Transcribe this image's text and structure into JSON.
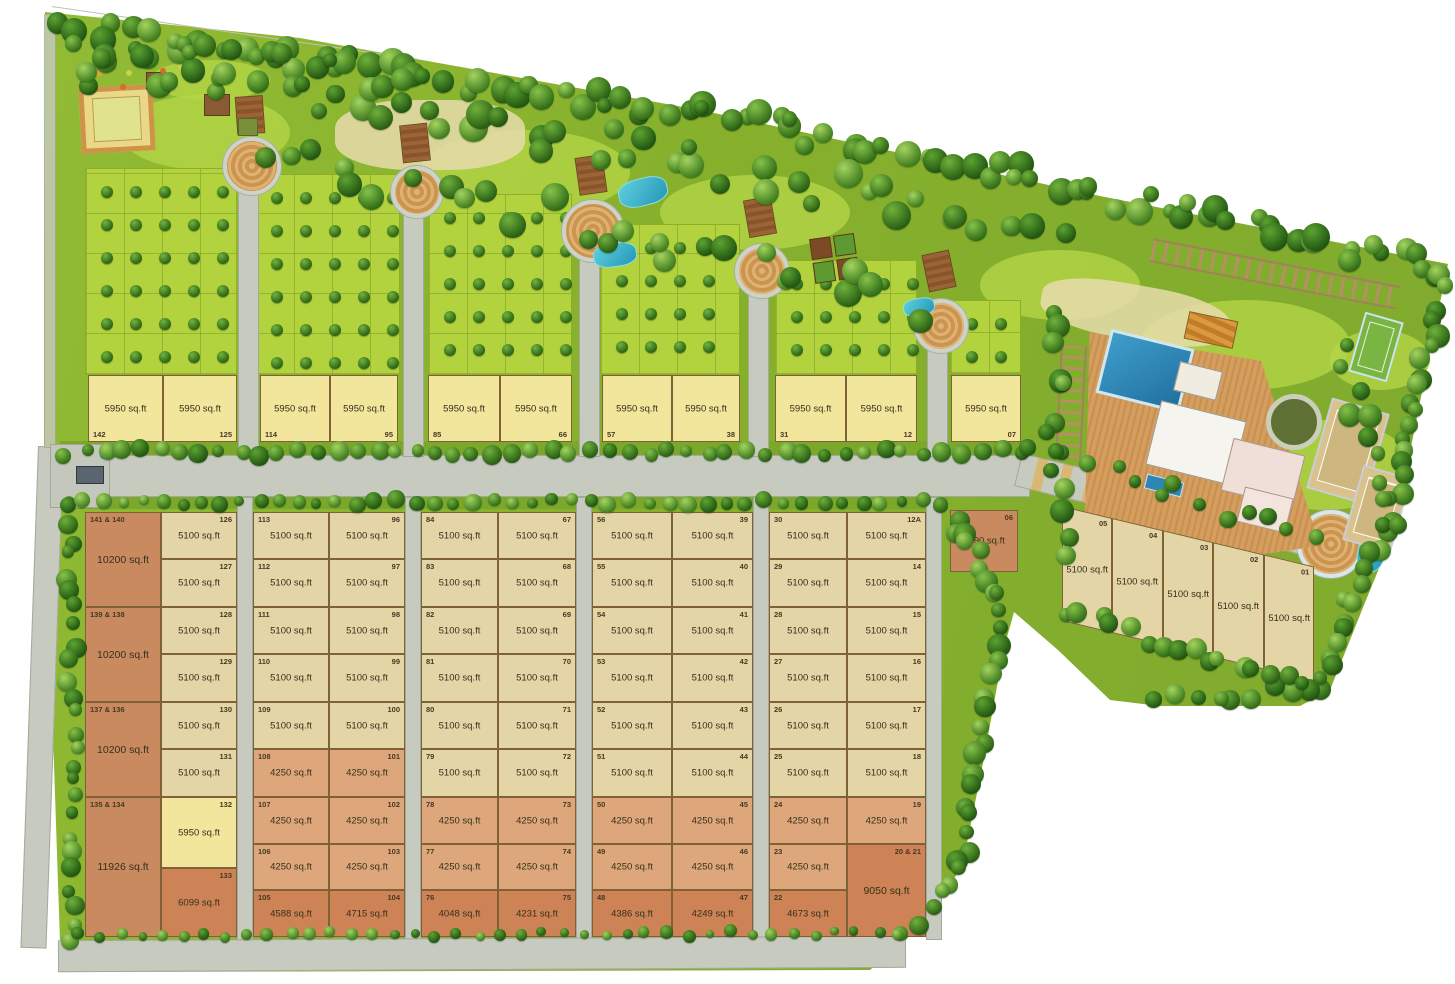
{
  "map": {
    "kind": "residential plotted development master plan",
    "area_unit": "sq.ft"
  },
  "colors": {
    "plot_5950": "#f2e59c",
    "plot_5100": "#e4d5a6",
    "plot_4250": "#dda77b",
    "plot_corner": "#cd8355",
    "plot_large": "#c98a60",
    "road": "#c7cabf",
    "lawn": "#a8cc35",
    "tree": "#2f6a16",
    "water": "#35b6c9",
    "deck": "#d0975a"
  },
  "top_row": [
    {
      "no": "142",
      "size": "5950 sq.ft"
    },
    {
      "no": "125",
      "size": "5950 sq.ft"
    },
    {
      "no": "114",
      "size": "5950 sq.ft"
    },
    {
      "no": "95",
      "size": "5950 sq.ft"
    },
    {
      "no": "85",
      "size": "5950 sq.ft"
    },
    {
      "no": "66",
      "size": "5950 sq.ft"
    },
    {
      "no": "57",
      "size": "5950 sq.ft"
    },
    {
      "no": "38",
      "size": "5950 sq.ft"
    },
    {
      "no": "31",
      "size": "5950 sq.ft"
    },
    {
      "no": "12",
      "size": "5950 sq.ft"
    },
    {
      "no": "07",
      "size": "5950 sq.ft"
    }
  ],
  "col1_left": [
    {
      "no": "141 & 140",
      "size": "10200 sq.ft"
    },
    {
      "no": "139 & 138",
      "size": "10200 sq.ft"
    },
    {
      "no": "137 & 136",
      "size": "10200 sq.ft"
    },
    {
      "no": "135 & 134",
      "size": "11926 sq.ft"
    }
  ],
  "col1_right": [
    {
      "no": "126",
      "size": "5100 sq.ft"
    },
    {
      "no": "127",
      "size": "5100 sq.ft"
    },
    {
      "no": "128",
      "size": "5100 sq.ft"
    },
    {
      "no": "129",
      "size": "5100 sq.ft"
    },
    {
      "no": "130",
      "size": "5100 sq.ft"
    },
    {
      "no": "131",
      "size": "5100 sq.ft"
    },
    {
      "no": "132",
      "size": "5950 sq.ft"
    },
    {
      "no": "133",
      "size": "6099 sq.ft"
    }
  ],
  "col2_left": [
    {
      "no": "113",
      "size": "5100 sq.ft"
    },
    {
      "no": "112",
      "size": "5100 sq.ft"
    },
    {
      "no": "111",
      "size": "5100 sq.ft"
    },
    {
      "no": "110",
      "size": "5100 sq.ft"
    },
    {
      "no": "109",
      "size": "5100 sq.ft"
    },
    {
      "no": "108",
      "size": "4250 sq.ft"
    },
    {
      "no": "107",
      "size": "4250 sq.ft"
    },
    {
      "no": "106",
      "size": "4250 sq.ft"
    },
    {
      "no": "105",
      "size": "4588 sq.ft"
    }
  ],
  "col2_right": [
    {
      "no": "96",
      "size": "5100 sq.ft"
    },
    {
      "no": "97",
      "size": "5100 sq.ft"
    },
    {
      "no": "98",
      "size": "5100 sq.ft"
    },
    {
      "no": "99",
      "size": "5100 sq.ft"
    },
    {
      "no": "100",
      "size": "5100 sq.ft"
    },
    {
      "no": "101",
      "size": "4250 sq.ft"
    },
    {
      "no": "102",
      "size": "4250 sq.ft"
    },
    {
      "no": "103",
      "size": "4250 sq.ft"
    },
    {
      "no": "104",
      "size": "4715 sq.ft"
    }
  ],
  "col3_left": [
    {
      "no": "84",
      "size": "5100 sq.ft"
    },
    {
      "no": "83",
      "size": "5100 sq.ft"
    },
    {
      "no": "82",
      "size": "5100 sq.ft"
    },
    {
      "no": "81",
      "size": "5100 sq.ft"
    },
    {
      "no": "80",
      "size": "5100 sq.ft"
    },
    {
      "no": "79",
      "size": "5100 sq.ft"
    },
    {
      "no": "78",
      "size": "4250 sq.ft"
    },
    {
      "no": "77",
      "size": "4250 sq.ft"
    },
    {
      "no": "76",
      "size": "4048 sq.ft"
    }
  ],
  "col3_right": [
    {
      "no": "67",
      "size": "5100 sq.ft"
    },
    {
      "no": "68",
      "size": "5100 sq.ft"
    },
    {
      "no": "69",
      "size": "5100 sq.ft"
    },
    {
      "no": "70",
      "size": "5100 sq.ft"
    },
    {
      "no": "71",
      "size": "5100 sq.ft"
    },
    {
      "no": "72",
      "size": "5100 sq.ft"
    },
    {
      "no": "73",
      "size": "4250 sq.ft"
    },
    {
      "no": "74",
      "size": "4250 sq.ft"
    },
    {
      "no": "75",
      "size": "4231 sq.ft"
    }
  ],
  "col4_left": [
    {
      "no": "56",
      "size": "5100 sq.ft"
    },
    {
      "no": "55",
      "size": "5100 sq.ft"
    },
    {
      "no": "54",
      "size": "5100 sq.ft"
    },
    {
      "no": "53",
      "size": "5100 sq.ft"
    },
    {
      "no": "52",
      "size": "5100 sq.ft"
    },
    {
      "no": "51",
      "size": "5100 sq.ft"
    },
    {
      "no": "50",
      "size": "4250 sq.ft"
    },
    {
      "no": "49",
      "size": "4250 sq.ft"
    },
    {
      "no": "48",
      "size": "4386 sq.ft"
    }
  ],
  "col4_right": [
    {
      "no": "39",
      "size": "5100 sq.ft"
    },
    {
      "no": "40",
      "size": "5100 sq.ft"
    },
    {
      "no": "41",
      "size": "5100 sq.ft"
    },
    {
      "no": "42",
      "size": "5100 sq.ft"
    },
    {
      "no": "43",
      "size": "5100 sq.ft"
    },
    {
      "no": "44",
      "size": "5100 sq.ft"
    },
    {
      "no": "45",
      "size": "4250 sq.ft"
    },
    {
      "no": "46",
      "size": "4250 sq.ft"
    },
    {
      "no": "47",
      "size": "4249 sq.ft"
    }
  ],
  "col5_left": [
    {
      "no": "30",
      "size": "5100 sq.ft"
    },
    {
      "no": "29",
      "size": "5100 sq.ft"
    },
    {
      "no": "28",
      "size": "5100 sq.ft"
    },
    {
      "no": "27",
      "size": "5100 sq.ft"
    },
    {
      "no": "26",
      "size": "5100 sq.ft"
    },
    {
      "no": "25",
      "size": "5100 sq.ft"
    },
    {
      "no": "24",
      "size": "4250 sq.ft"
    },
    {
      "no": "23",
      "size": "4250 sq.ft"
    },
    {
      "no": "22",
      "size": "4673 sq.ft"
    }
  ],
  "col5_right": [
    {
      "no": "12A",
      "size": "5100 sq.ft"
    },
    {
      "no": "14",
      "size": "5100 sq.ft"
    },
    {
      "no": "15",
      "size": "5100 sq.ft"
    },
    {
      "no": "16",
      "size": "5100 sq.ft"
    },
    {
      "no": "17",
      "size": "5100 sq.ft"
    },
    {
      "no": "18",
      "size": "5100 sq.ft"
    },
    {
      "no": "19",
      "size": "4250 sq.ft"
    },
    {
      "no": "20 & 21",
      "size": "9050 sq.ft"
    }
  ],
  "plot06": {
    "no": "06",
    "size": "6190 sq.ft"
  },
  "east_row": [
    {
      "no": "05",
      "size": "5100 sq.ft"
    },
    {
      "no": "04",
      "size": "5100 sq.ft"
    },
    {
      "no": "03",
      "size": "5100 sq.ft"
    },
    {
      "no": "02",
      "size": "5100 sq.ft"
    },
    {
      "no": "01",
      "size": "5100 sq.ft"
    }
  ]
}
